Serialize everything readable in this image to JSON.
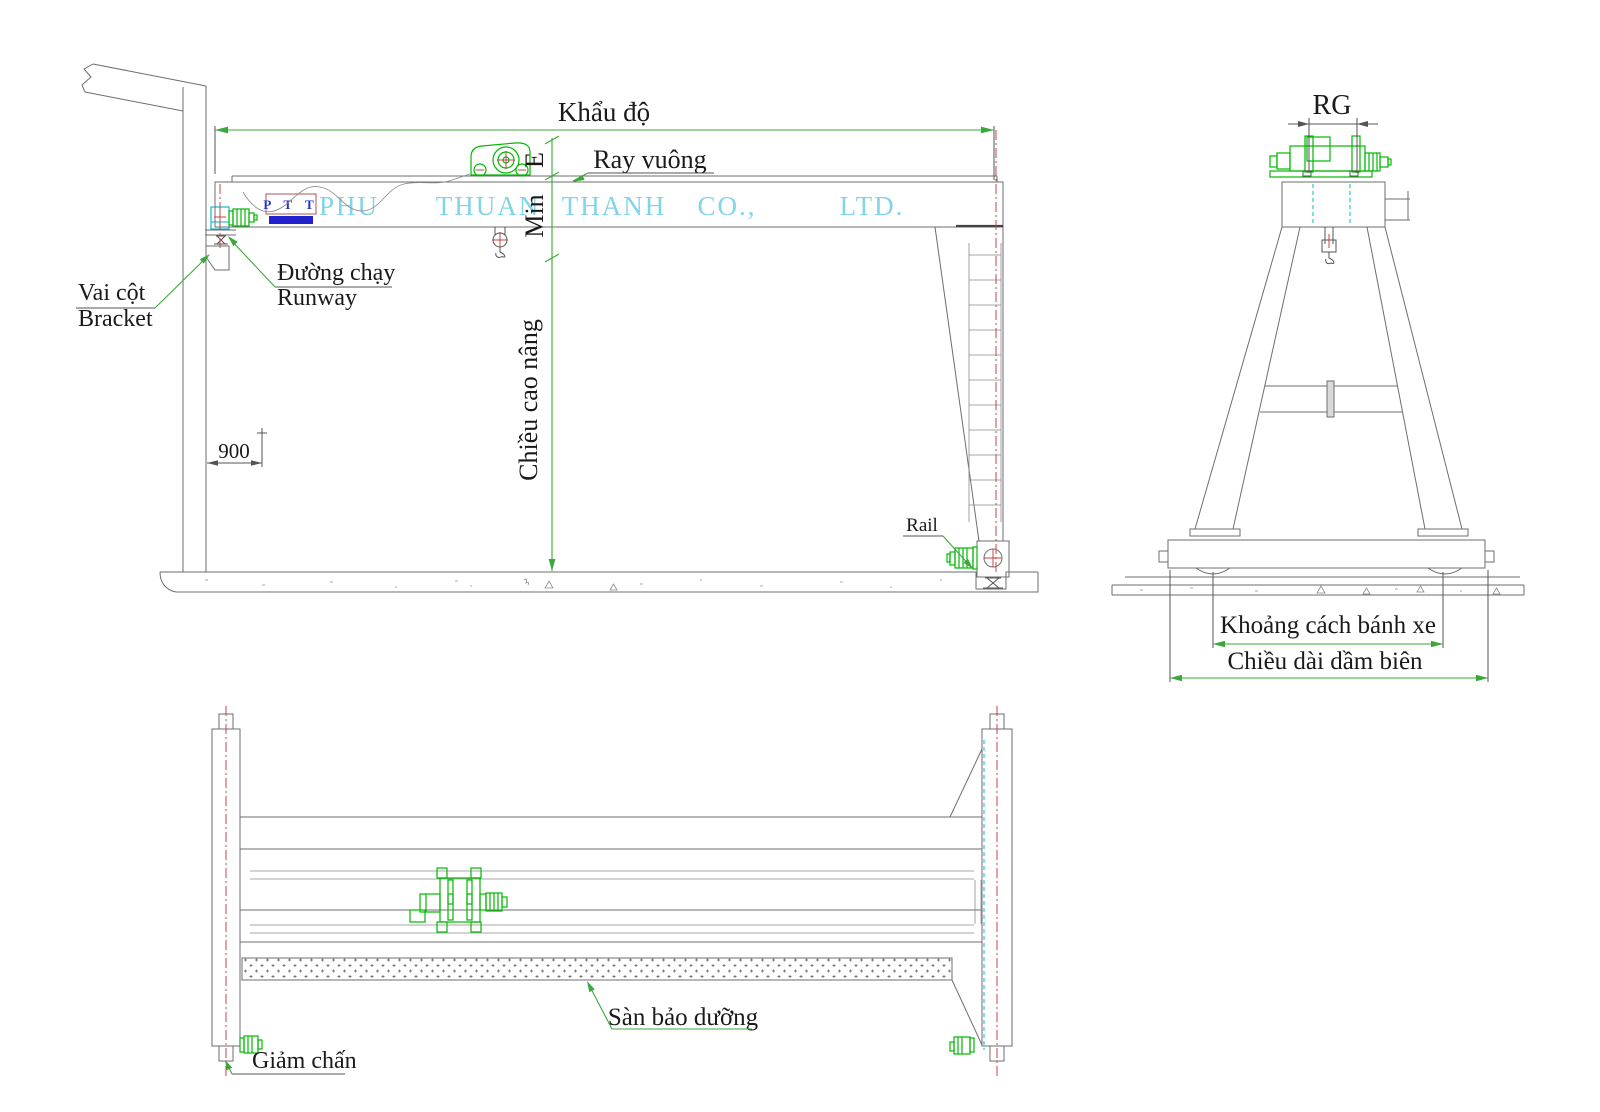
{
  "company": {
    "logo": "P T T",
    "words": [
      "PHU",
      "THUAN",
      "THANH",
      "CO.,",
      "LTD."
    ]
  },
  "side_view": {
    "span_label": "Khẩu độ",
    "square_rail_label": "Ray vuông",
    "runway_vi": "Đường chạy",
    "runway_en": "Runway",
    "bracket_vi": "Vai cột",
    "bracket_en": "Bracket",
    "dim_900": "900",
    "dim_e": "E",
    "dim_min": "Min",
    "lifting_height_label": "Chiều cao nâng",
    "rail_label": "Rail"
  },
  "end_view": {
    "rail_gauge_label": "RG",
    "wheel_spacing_label": "Khoảng cách bánh xe",
    "end_carriage_length_label": "Chiều dài dầm biên"
  },
  "plan_view": {
    "maintenance_platform_label": "Sàn bảo dưỡng",
    "buffer_label": "Giảm chấn"
  },
  "colors": {
    "dimension_green": "#3aa83a",
    "equipment_green": "#00b800",
    "company_cyan": "#82d4e8",
    "logo_blue": "#2233cc",
    "centerline_red": "#c04545",
    "line_gray": "#6e6e6e",
    "rail_cyan": "#00b0c8"
  }
}
